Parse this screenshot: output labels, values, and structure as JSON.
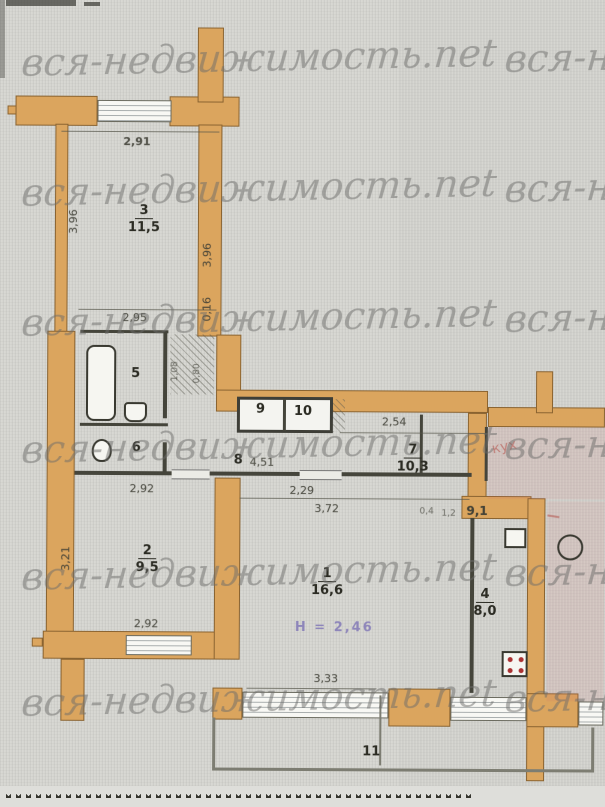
{
  "watermark": {
    "full": "вся-недвижимость.net",
    "clipped": "вся-н"
  },
  "colors": {
    "wall": "#d9a45f",
    "wall_outline": "#8a6432",
    "paper": "#d6d6d1",
    "ink": "#3c3c33",
    "watermark": "#6c6c6a",
    "height_note": "#7d74b4",
    "red_annotation": "#b24a42"
  },
  "rooms": {
    "r1": {
      "number": "1",
      "area": "16,6"
    },
    "r2": {
      "number": "2",
      "area": "9,5"
    },
    "r3": {
      "number": "3",
      "area": "11,5"
    },
    "r4": {
      "number": "4",
      "area": "8,0"
    },
    "r5": {
      "number": "5"
    },
    "r6": {
      "number": "6"
    },
    "r7": {
      "number": "7",
      "area": "10,3"
    },
    "r8": {
      "number": "8"
    },
    "r9": {
      "number": "9"
    },
    "r10": {
      "number": "10"
    },
    "r11": {
      "number": "11"
    }
  },
  "dims": {
    "top_width": "2,91",
    "room3_height_left": "3,96",
    "room3_height_right": "3,96",
    "room3_offset": "0,16",
    "room3_width": "2,95",
    "niche_a": "1,08",
    "niche_b": "0,80",
    "hall_top": "2,54",
    "corridor": "4,51",
    "room2_top": "2,92",
    "room2_bottom": "2,92",
    "room2_height": "3,21",
    "room1_top_left": "2,29",
    "room1_top": "3,72",
    "kitchen_small_a": "0,4",
    "kitchen_small_b": "1,2",
    "kitchen_bold": "9,1",
    "balcony": "3,33"
  },
  "notes": {
    "ceiling_height": "H = 2,46",
    "red_annotation": "кух"
  }
}
